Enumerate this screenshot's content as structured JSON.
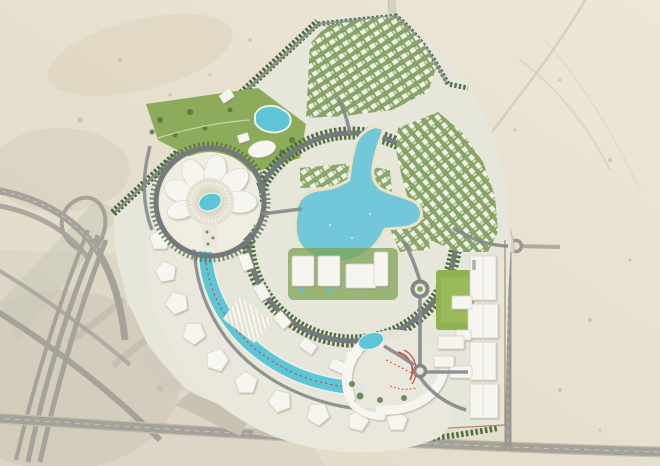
{
  "meta": {
    "view_type": "aerial-masterplan-render",
    "canvas": {
      "width": 660,
      "height": 466
    },
    "visible_text": "none (only tiny illegible red marker strings along the canal and waterpark)"
  },
  "palette": {
    "sandBase": "#e6dfcd",
    "sandLight": "#ece5d4",
    "sandDark": "#d9cfba",
    "sandPatch": "#cec7b6",
    "constructionGray": "#c9c2b2",
    "roadGray": "#a5a29a",
    "roadDark": "#75797c",
    "roadLane": "#dad7cb",
    "siteBase": "#e7e6da",
    "treeDark": "#476b3a",
    "parkGreen": "#8cab5b",
    "fieldGreen": "#8fb353",
    "lawnLight": "#9cbd5e",
    "villaGreen": "#7da455",
    "water": "#5cc6d7",
    "lagoon": "#72c8d8",
    "beach": "#ece2c8",
    "building": "#f6f5ef",
    "buildingEdge": "#d6d3c8",
    "hubCream": "#f0ede1",
    "plazaLight": "#eae8dc",
    "redAccent": "#d23b33",
    "boundaryBrown": "#b08968"
  },
  "features": [
    {
      "id": "desert-backdrop",
      "label": "Undeveloped desert land surrounding the site"
    },
    {
      "id": "highway-interchange",
      "label": "Multi-lane highway interchange, lower left"
    },
    {
      "id": "bottom-road",
      "label": "Arterial road along the bottom edge"
    },
    {
      "id": "right-road",
      "label": "Arterial road along the right edge"
    },
    {
      "id": "perimeter-road",
      "label": "Sand-coloured perimeter road along the north-east boundary"
    },
    {
      "id": "development-site",
      "label": "Fan-shaped master-planned development"
    },
    {
      "id": "central-hub",
      "label": "Flower-shaped central hub building with circular plaza and oval pool"
    },
    {
      "id": "north-park",
      "label": "Landscaped park with ornamental pond and museum building"
    },
    {
      "id": "villa-district-north",
      "label": "Rows of villas, northern district"
    },
    {
      "id": "villa-district-east",
      "label": "Rows of villas, eastern district"
    },
    {
      "id": "lagoon",
      "label": "Swimmable turquoise lagoon with beach edge and channels"
    },
    {
      "id": "lagoon-loop-road",
      "label": "Tree-lined loop road around the lagoon district"
    },
    {
      "id": "apartment-blocks",
      "label": "Mid-rise apartment blocks south of the lagoon"
    },
    {
      "id": "central-spine",
      "label": "Curved retail boulevard spine with water canal"
    },
    {
      "id": "canal",
      "label": "Canal with tiny red accent markers"
    },
    {
      "id": "canopy-pavilions",
      "label": "White tent-like pavilion buildings along the boulevard"
    },
    {
      "id": "waterpark-complex",
      "label": "Entertainment complex with pool and red water slides"
    },
    {
      "id": "sports-field",
      "label": "Green sports field"
    },
    {
      "id": "campus-buildings",
      "label": "School / campus building cluster, east side"
    },
    {
      "id": "roundabouts",
      "label": "Roundabout junctions"
    },
    {
      "id": "construction-plots",
      "label": "Graded future plots near the south-west edge"
    }
  ]
}
